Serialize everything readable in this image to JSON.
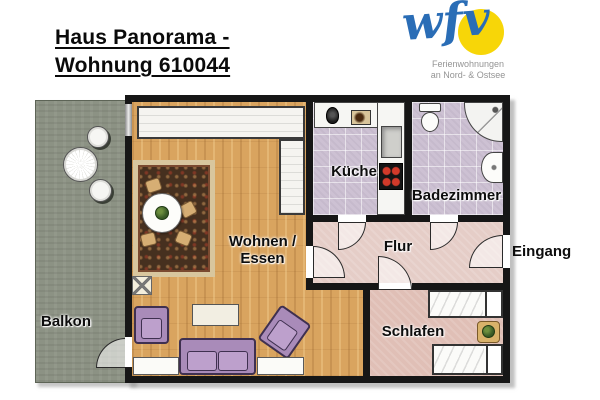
{
  "header": {
    "title_line1": "Haus Panorama -",
    "title_line2": "Wohnung 610044"
  },
  "logo": {
    "wordmark": "wfv",
    "tagline_line1": "Ferienwohnungen",
    "tagline_line2": "an Nord- & Ostsee",
    "colors": {
      "blue": "#2a6db6",
      "yellow": "#f7d608",
      "gray": "#949494"
    }
  },
  "floorplan": {
    "labels": {
      "living_line1": "Wohnen /",
      "living_line2": "Essen",
      "kitchen": "Küche",
      "bathroom": "Badezimmer",
      "hallway": "Flur",
      "entrance": "Eingang",
      "bedroom": "Schlafen",
      "balcony": "Balkon"
    },
    "colors": {
      "wall": "#161616",
      "wood_floor": "#d9a45f",
      "tile_floor": "#cdc1d3",
      "hall_floor": "#e5cdc7",
      "bedroom_floor": "#e0bfb6",
      "balcony_floor": "#8c9284",
      "furniture_purple": "#b294c2",
      "rug_field": "#46301f",
      "rug_border": "#d8c69e"
    },
    "fixtures": {
      "kitchen": [
        "kettle",
        "microwave",
        "sink",
        "stove",
        "counter"
      ],
      "bathroom": [
        "toilet",
        "shower",
        "washbasin"
      ],
      "living": [
        "wardrobe",
        "sideboard",
        "rug",
        "dining-table",
        "dining-chairs",
        "plant",
        "lamp-table",
        "armchair",
        "armchair",
        "sofa",
        "coffee-table",
        "window-bench",
        "window-bench"
      ],
      "bedroom": [
        "single-bed",
        "single-bed",
        "nightstand",
        "plant"
      ],
      "balcony": [
        "round-table",
        "chair",
        "chair"
      ]
    }
  }
}
